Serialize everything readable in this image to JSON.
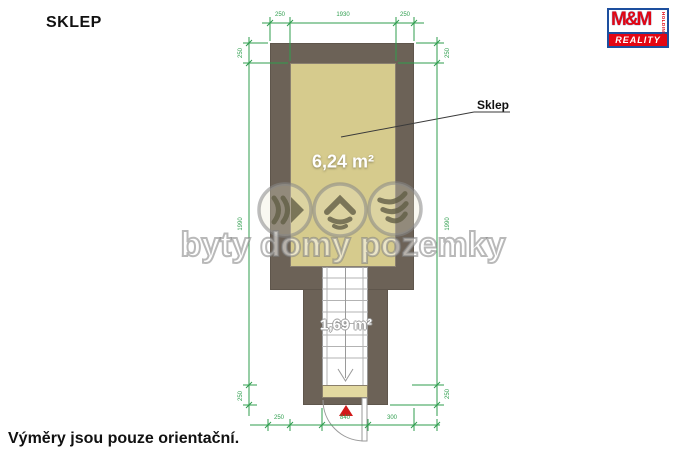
{
  "title": "SKLEP",
  "footer_note": "Výměry jsou pouze orientační.",
  "logo": {
    "mm": "M&M",
    "holding": "HOLDING",
    "reality": "REALITY",
    "red": "#e30613",
    "blue": "#1d4f9e"
  },
  "watermark": {
    "text": "byty domy pozemky"
  },
  "plan": {
    "room_label": "Sklep",
    "room_area": "6,24 m²",
    "stairs_area": "1,69 m²",
    "colors": {
      "wall": "#6c6257",
      "room_fill": "#d6cb8d",
      "landing_fill": "#e3d9a0",
      "dimension_lines": "#2f9e4e",
      "entrance_marker": "#d11a1a"
    },
    "dimensions": {
      "top": [
        "250",
        "1930",
        "250"
      ],
      "left": [
        "250",
        "1990",
        "250"
      ],
      "right": [
        "250",
        "1990",
        "250"
      ],
      "bottom": [
        "250",
        "840",
        "300"
      ]
    }
  }
}
